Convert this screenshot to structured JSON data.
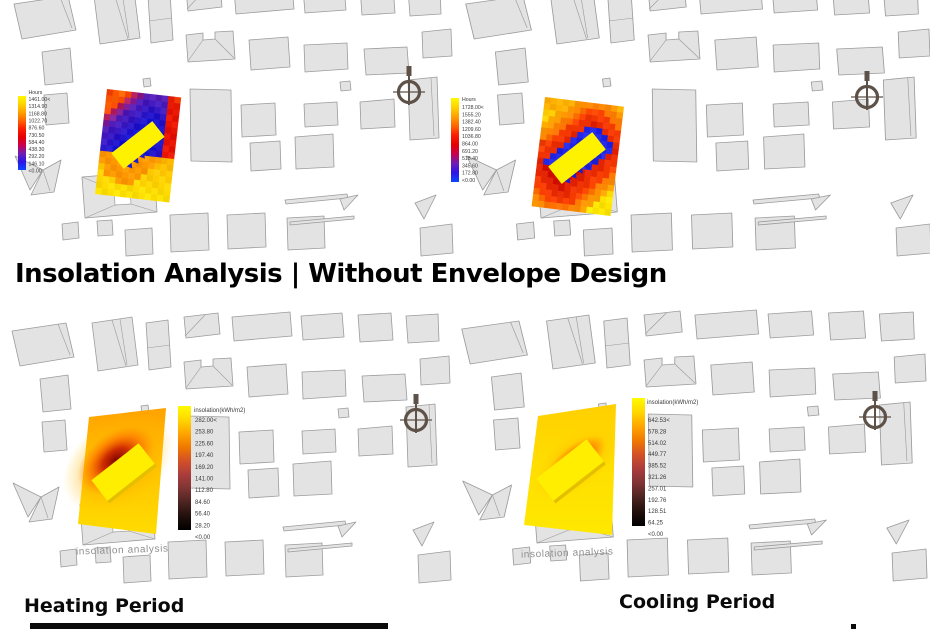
{
  "header": {
    "title": "Insolation Analysis | Without Envelope Design"
  },
  "footer": {
    "heating_label": "Heating Period",
    "cooling_label": "Cooling Period"
  },
  "watermark": {
    "text": "insolation analysis"
  },
  "chart_data": [
    {
      "id": "sunlight-hours-left",
      "type": "heatmap",
      "style": "pixelated-grid",
      "scene": "urban block plan with analysis patch around central building",
      "legend_title": "Hours",
      "legend_ticks": [
        "1461.00<",
        "1314.90",
        "1168.80",
        "1022.70",
        "876.60",
        "730.50",
        "584.40",
        "438.30",
        "292.20",
        "146.10",
        "<0.00"
      ],
      "legend_position": "left-edge",
      "palette_high_to_low": [
        "#fffb00",
        "#ffd200",
        "#ffa000",
        "#ff6400",
        "#fb1e00",
        "#e60000",
        "#c80050",
        "#6e1eb4",
        "#2d14e6",
        "#0a46ff"
      ]
    },
    {
      "id": "sunlight-hours-right",
      "type": "heatmap",
      "style": "pixelated-grid",
      "scene": "urban block plan with analysis patch around central building",
      "legend_title": "Hours",
      "legend_ticks": [
        "1728.00<",
        "1555.20",
        "1382.40",
        "1209.60",
        "1036.80",
        "864.00",
        "691.20",
        "518.40",
        "345.60",
        "172.80",
        "<0.00"
      ],
      "legend_position": "left-edge",
      "palette_high_to_low": [
        "#fffb00",
        "#ffd200",
        "#ffa000",
        "#ff6400",
        "#fb1e00",
        "#e60000",
        "#c80050",
        "#6e1eb4",
        "#2d14e6",
        "#0a46ff"
      ]
    },
    {
      "id": "insolation-heating-period",
      "type": "heatmap",
      "style": "smooth-gradient",
      "period": "Heating Period",
      "scene": "urban block plan, smooth insolation field around central building",
      "legend_title": "insolation(kWh/m2)",
      "legend_ticks": [
        "282.00<",
        "253.80",
        "225.60",
        "197.40",
        "169.20",
        "141.00",
        "112.80",
        "84.60",
        "56.40",
        "28.20",
        "<0.00"
      ],
      "legend_position": "right-of-patch",
      "palette_high_to_low": [
        "#fffb00",
        "#ffd700",
        "#ffa500",
        "#f07800",
        "#d25028",
        "#aa3c3c",
        "#7d3434",
        "#4b2420",
        "#20100c",
        "#000000"
      ]
    },
    {
      "id": "insolation-cooling-period",
      "type": "heatmap",
      "style": "smooth-gradient",
      "period": "Cooling Period",
      "scene": "urban block plan, smooth insolation field around central building",
      "legend_title": "insolation(kWh/m2)",
      "legend_ticks": [
        "642.53<",
        "578.28",
        "514.02",
        "449.77",
        "385.52",
        "321.26",
        "257.01",
        "192.76",
        "128.51",
        "64.25",
        "<0.00"
      ],
      "legend_position": "right-of-patch",
      "palette_high_to_low": [
        "#fffb00",
        "#ffd700",
        "#ffa500",
        "#f07800",
        "#d25028",
        "#aa3c3c",
        "#7d3434",
        "#4b2420",
        "#20100c",
        "#000000"
      ]
    }
  ],
  "colors": {
    "building_fill": "#e3e3e3",
    "building_stroke": "#9b9b9b",
    "analysis_building": "#fff200",
    "analysis_building_bottom": "#ffee00",
    "shadow_tooth": "#1d1dcb",
    "compass": "#5d5148",
    "legend_text": "#3a3a3a",
    "title_text": "#000000",
    "watermark_text": "#8f8f8f"
  }
}
